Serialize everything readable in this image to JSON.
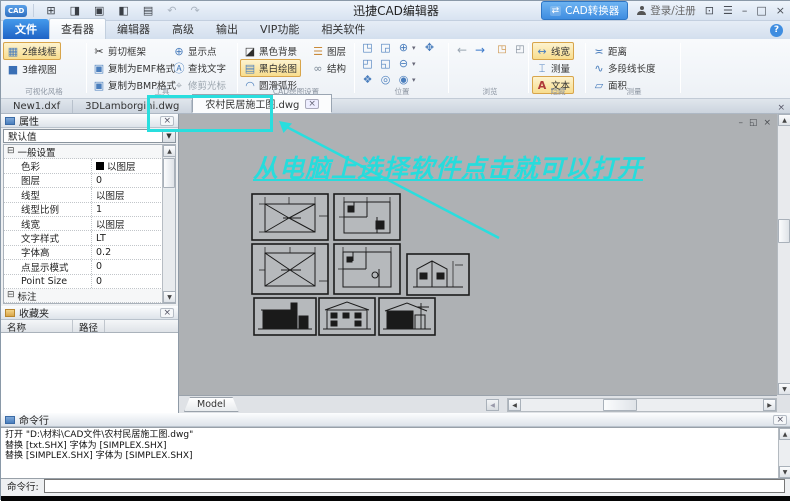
{
  "glyphs": {
    "qat_new": "⊞",
    "qat_open": "◨",
    "qat_save": "▣",
    "qat_pdf": "◧",
    "qat_print": "▤",
    "undo": "↶",
    "redo": "↷",
    "converter": "⇄",
    "feedback": "⊡",
    "menu": "☰",
    "minimize": "–",
    "maximize": "□",
    "close": "×",
    "help": "?",
    "up": "▲",
    "down": "▼",
    "left": "◀",
    "right": "▶",
    "dropdown": "▼",
    "small_down": "▾",
    "expander": "⊟",
    "mdi_min": "–",
    "mdi_restore": "◱",
    "mdi_close": "×",
    "tab_close": "×",
    "back": "←",
    "forward": "→",
    "page1": "◳",
    "page2": "◰"
  },
  "titlebar": {
    "logo": "CAD",
    "app_title": "迅捷CAD编辑器",
    "converter_button": "CAD转换器",
    "login": "登录/注册"
  },
  "menu": {
    "file": "文件",
    "tabs": [
      {
        "label": "查看器"
      },
      {
        "label": "编辑器"
      },
      {
        "label": "高级"
      },
      {
        "label": "输出"
      },
      {
        "label": "VIP功能"
      },
      {
        "label": "相关软件"
      }
    ]
  },
  "ribbon": {
    "groups": {
      "visual": {
        "label": "可视化风格",
        "items": [
          {
            "icon": "▦",
            "label": "2维线框"
          },
          {
            "icon": "■",
            "label": "3维视图"
          }
        ]
      },
      "tools": {
        "label": "工具",
        "col1": [
          {
            "icon": "✂",
            "label": "剪切框架"
          },
          {
            "icon": "▣",
            "label": "复制为EMF格式"
          },
          {
            "icon": "▣",
            "label": "复制为BMP格式"
          }
        ],
        "col2": [
          {
            "icon": "⊕",
            "label": "显示点"
          },
          {
            "icon": "Ⓐ",
            "label": "查找文字"
          },
          {
            "icon": "⌖",
            "label": "修剪光标"
          }
        ]
      },
      "cad_draw": {
        "label": "CAD绘图设置",
        "col1": [
          {
            "icon": "◪",
            "label": "黑色背景"
          },
          {
            "icon": "▤",
            "label": "黑白绘图"
          },
          {
            "icon": "◠",
            "label": "圆滑弧形"
          }
        ],
        "col2": [
          {
            "icon": "☰",
            "label": "图层"
          },
          {
            "icon": "∞",
            "label": "结构"
          }
        ]
      },
      "position": {
        "label": "位置",
        "icons": [
          "◳",
          "◲",
          "⊕",
          "✥",
          "◰",
          "◱",
          "⊖",
          "❖",
          "◎",
          "◉"
        ]
      },
      "browse": {
        "label": "浏览"
      },
      "hide": {
        "label": "隐藏",
        "items": [
          {
            "icon": "↔",
            "label": "线宽"
          },
          {
            "icon": "⌶",
            "label": "测量"
          },
          {
            "icon": "A",
            "label": "文本"
          }
        ]
      },
      "measure": {
        "label": "测量",
        "items": [
          {
            "icon": "≍",
            "label": "距离"
          },
          {
            "icon": "∿",
            "label": "多段线长度"
          },
          {
            "icon": "▱",
            "label": "面积"
          }
        ]
      }
    }
  },
  "doc_tabs": {
    "tabs": [
      {
        "label": "New1.dxf"
      },
      {
        "label": "3DLamborgini.dwg"
      },
      {
        "label": "农村民居施工图.dwg"
      }
    ]
  },
  "properties_panel": {
    "title": "属性",
    "preset": "默认值",
    "section_general": "一般设置",
    "rows": [
      {
        "name": "色彩",
        "value": "以图层"
      },
      {
        "name": "图层",
        "value": "0"
      },
      {
        "name": "线型",
        "value": "以图层"
      },
      {
        "name": "线型比例",
        "value": "1"
      },
      {
        "name": "线宽",
        "value": "以图层"
      },
      {
        "name": "文字样式",
        "value": "LT"
      },
      {
        "name": "字体高",
        "value": "0.2"
      },
      {
        "name": "点显示模式",
        "value": "0"
      },
      {
        "name": "Point Size",
        "value": "0"
      }
    ],
    "section_dim": "标注"
  },
  "favorites_panel": {
    "title": "收藏夹",
    "col_name": "名称",
    "col_path": "路径"
  },
  "canvas": {
    "model_tab": "Model",
    "annotation": "从电脑上选择软件点击就可以打开"
  },
  "command_panel": {
    "title": "命令行",
    "lines": [
      "打开 \"D:\\材料\\CAD文件\\农村民居施工图.dwg\"",
      "替换 [txt.SHX] 字体为 [SIMPLEX.SHX]",
      "替换 [SIMPLEX.SHX] 字体为 [SIMPLEX.SHX]"
    ],
    "prompt": "命令行:"
  },
  "colors": {
    "annotation_cyan": "#29dede",
    "highlight_orange": "#f8dd8e",
    "file_button_blue": "#2f7bd9",
    "converter_blue": "#3f8de0",
    "canvas_gray": "#aeb1b4"
  }
}
